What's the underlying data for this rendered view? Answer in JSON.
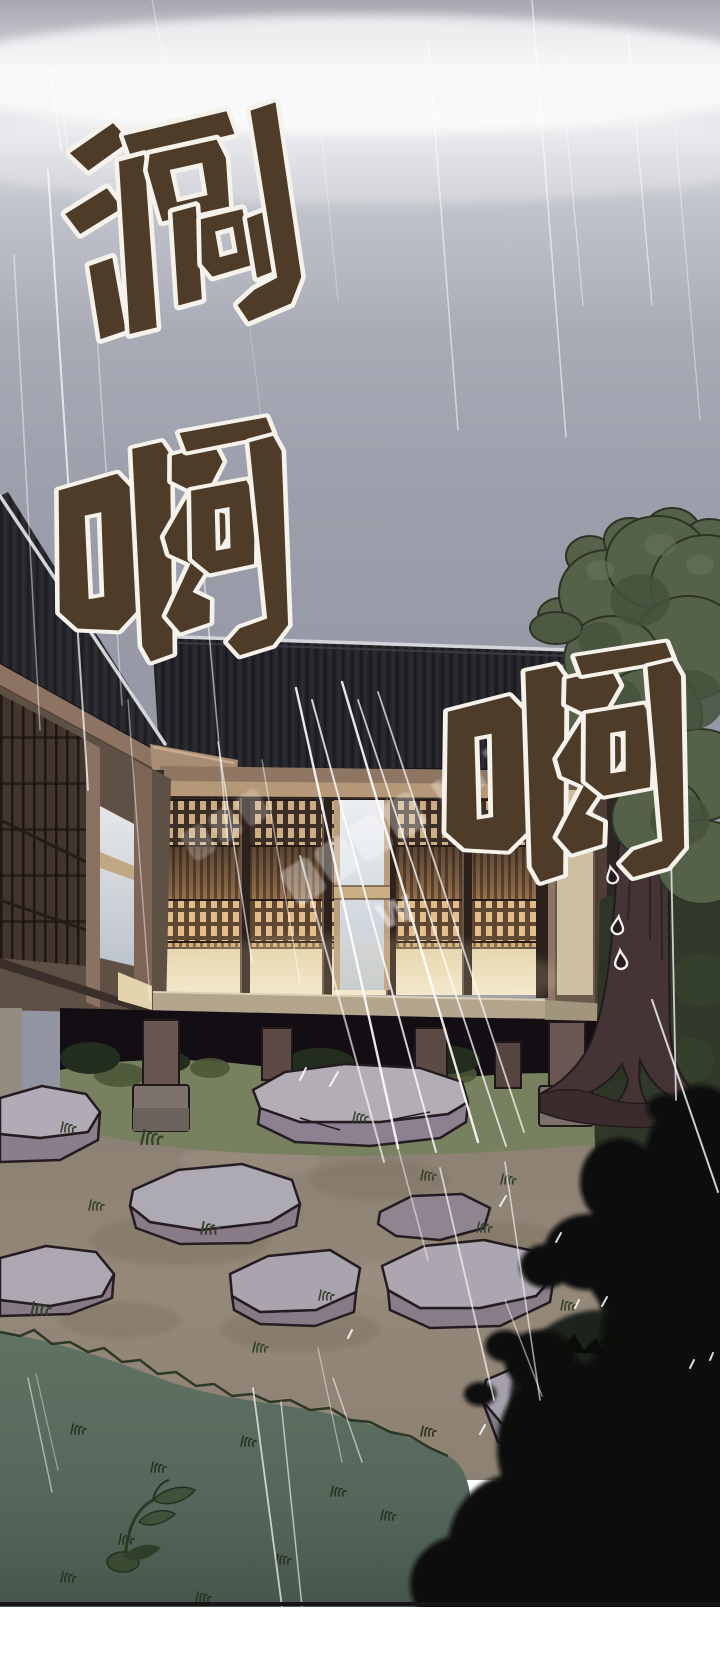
{
  "panel": {
    "kind": "webtoon comic panel",
    "scene": "Heavy rain falling at dusk on a traditional wooden house with glowing lattice doors, a stone-path garden, a large tree at right and a dark bush silhouette in the foreground"
  },
  "sfx": [
    {
      "char": "涮",
      "label": "rain sound effect (top left)"
    },
    {
      "char": "啊",
      "label": "rain sound effect (middle left)"
    },
    {
      "char": "啊",
      "label": "rain sound effect (middle right)"
    }
  ],
  "watermark": {
    "fragment": "mai",
    "mark": "W",
    "style": "diagonal translucent white"
  },
  "colors": {
    "sky_top": "#a6a7b0",
    "sky_mist": "#f2f2f4",
    "sky_gray": "#9396a2",
    "roof": "#26252b",
    "roof_ridge_light": "#d4d5da",
    "fascia": "#8d7362",
    "door_glow": "#c09a66",
    "door_cream": "#ead9b6",
    "pale_window": "#d7dde3",
    "veranda_beam": "#b2a58c",
    "underfloor_shadow": "#120e13",
    "grass_mid": "#78815f",
    "grass_field": "#5f7263",
    "dirt": "#8f8478",
    "stone_top": "#b3aeb6",
    "stone_side": "#8d8090",
    "tree_foliage": "#56614a",
    "tree_trunk": "#443435",
    "bush_silhouette": "#0a0c08",
    "sfx_fill": "#4e3b28",
    "sfx_outline": "#f5f2ec"
  }
}
